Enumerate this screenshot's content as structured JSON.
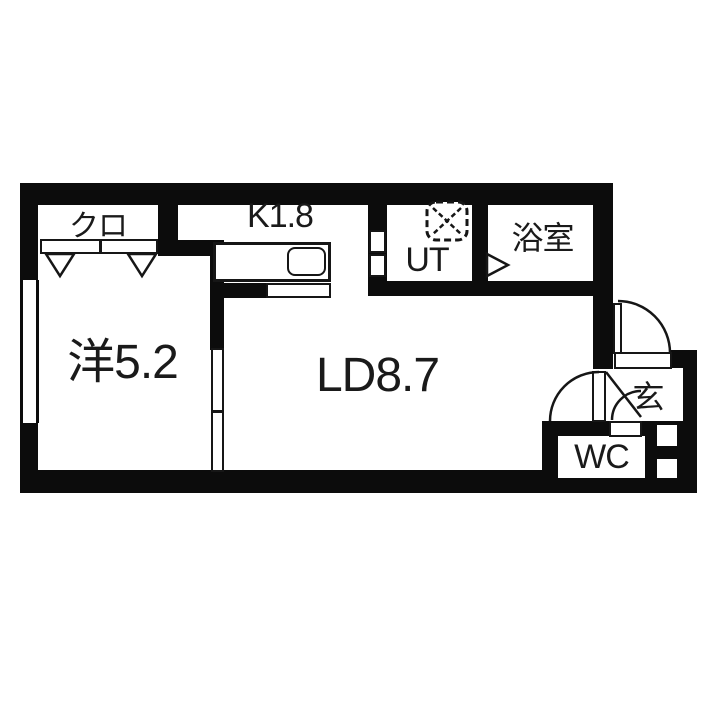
{
  "floorplan": {
    "type": "japanese-apartment-floor-plan",
    "rooms": {
      "closet": {
        "label": "クロ"
      },
      "kitchen": {
        "label": "K1.8"
      },
      "utility": {
        "label": "UT"
      },
      "bathroom": {
        "label": "浴室"
      },
      "western_room": {
        "label": "洋5.2"
      },
      "living_dining": {
        "label": "LD8.7"
      },
      "entrance": {
        "label": "玄"
      },
      "toilet": {
        "label": "WC"
      }
    },
    "colors": {
      "wall": "#0c0c0c",
      "floor": "#ffffff",
      "line": "#161616"
    },
    "symbols": [
      "closet-sliding-door",
      "closet-door-triangle",
      "window",
      "kitchen-counter",
      "kitchen-sink",
      "utility-folding-door",
      "washing-machine-placement",
      "bathroom-door-triangle",
      "sliding-door-western-ld",
      "front-door-swing-arc",
      "ld-door-swing-arc",
      "wc-door-swing-arc",
      "entrance-step"
    ]
  }
}
